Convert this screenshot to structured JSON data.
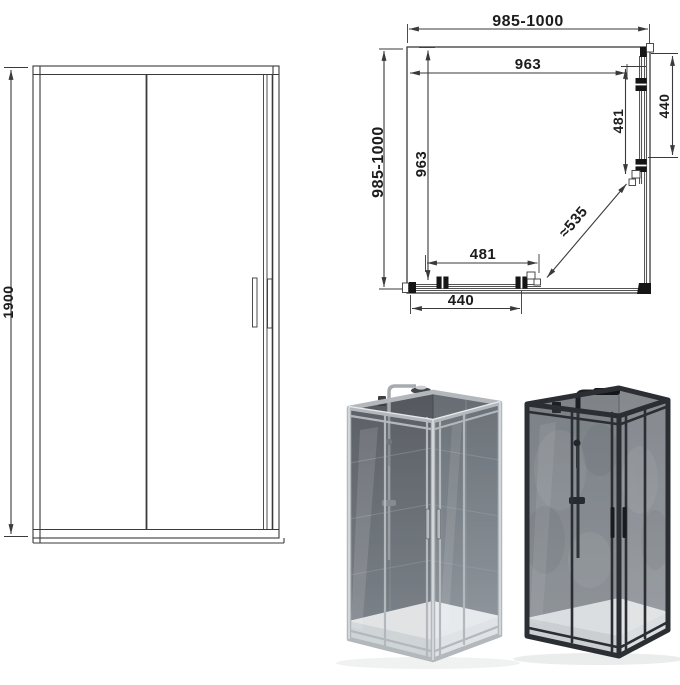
{
  "page": {
    "background": "#ffffff",
    "description": "Corner-entry sliding shower enclosure: front elevation drawing, plan view drawing with dimensions, and two product renders"
  },
  "drawing": {
    "line_color": "#3a3a3a",
    "text_color": "#1c1c1c"
  },
  "front_view": {
    "height": "1900"
  },
  "plan_view": {
    "overall_width": "985-1000",
    "overall_depth": "985-1000",
    "inner_width": "963",
    "inner_depth": "963",
    "side_door": "481",
    "side_fixed": "440",
    "front_door": "481",
    "front_fixed": "440",
    "diagonal_entry": "≈535"
  },
  "products": {
    "chrome": {
      "variant": "chrome-silver-frame",
      "frame_color": "#b3b8bd"
    },
    "black": {
      "variant": "matte-black-frame",
      "frame_color": "#2b2e32"
    }
  }
}
